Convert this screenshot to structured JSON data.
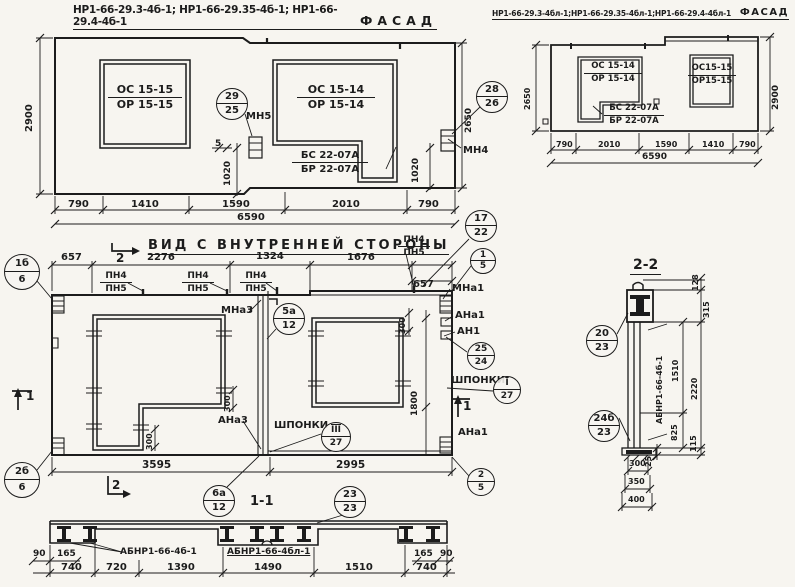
{
  "left_facade": {
    "codes": "НР1-66-29.3-4б-1; НР1-66-29.35-4б-1; НР1-66-29.4-4б-1",
    "view_label": "ФАСАД"
  },
  "right_facade": {
    "codes": "НР1-66-29.3-4бл-1;НР1-66-29.35-4бл-1;НР1-66-29.4-4бл-1",
    "view_label": "ФАСАД"
  },
  "inner_view": {
    "title": "ВИД С ВНУТРЕННЕЙ СТОРОНЫ"
  },
  "sections": {
    "s22": "2-2",
    "s11": "1-1"
  },
  "stacks": [
    {
      "n": "window1-left-facade-mark",
      "l1": "ОС 15-15",
      "l2": "ОР 15-15",
      "x": 108,
      "y": 84,
      "w": 74,
      "s": 11
    },
    {
      "n": "window2-left-facade-mark",
      "l1": "ОС 15-14",
      "l2": "ОР 15-14",
      "x": 297,
      "y": 84,
      "w": 78,
      "s": 11
    },
    {
      "n": "block-mark-left-facade",
      "l1": "БС 22-07А",
      "l2": "БР 22-07А",
      "x": 292,
      "y": 150,
      "w": 76,
      "s": 10
    },
    {
      "n": "window1-right-facade-mark",
      "l1": "ОС 15-14",
      "l2": "ОР 15-14",
      "x": 584,
      "y": 62,
      "w": 58,
      "s": 8.5
    },
    {
      "n": "window2-right-facade-mark",
      "l1": "ОС15-15",
      "l2": "ОР15-15",
      "x": 688,
      "y": 64,
      "w": 48,
      "s": 8.5
    },
    {
      "n": "block-mark-right-facade",
      "l1": "БС 22-07А",
      "l2": "БР 22-07А",
      "x": 604,
      "y": 104,
      "w": 60,
      "s": 8.5
    },
    {
      "n": "pn-mark-1",
      "l1": "ПН4",
      "l2": "ПН5",
      "x": 100,
      "y": 271,
      "w": 32,
      "s": 9
    },
    {
      "n": "pn-mark-2",
      "l1": "ПН4",
      "l2": "ПН5",
      "x": 182,
      "y": 271,
      "w": 32,
      "s": 9
    },
    {
      "n": "pn-mark-3",
      "l1": "ПН4",
      "l2": "ПН5",
      "x": 240,
      "y": 271,
      "w": 32,
      "s": 9
    },
    {
      "n": "pn-mark-4",
      "l1": "ПН4",
      "l2": "ПН5",
      "x": 398,
      "y": 235,
      "w": 32,
      "s": 9
    }
  ],
  "callouts": [
    {
      "n": "callout-29-25",
      "top": "29",
      "bot": "25",
      "x": 232,
      "y": 104,
      "r": 16
    },
    {
      "n": "callout-28-26",
      "top": "28",
      "bot": "26",
      "x": 492,
      "y": 97,
      "r": 16
    },
    {
      "n": "callout-1b-6",
      "top": "1б",
      "bot": "6",
      "x": 22,
      "y": 272,
      "r": 18
    },
    {
      "n": "callout-2b-6",
      "top": "2б",
      "bot": "6",
      "x": 22,
      "y": 480,
      "r": 18
    },
    {
      "n": "callout-17-22",
      "top": "17",
      "bot": "22",
      "x": 481,
      "y": 226,
      "r": 16
    },
    {
      "n": "callout-1-5",
      "top": "1",
      "bot": "5",
      "x": 483,
      "y": 261,
      "r": 13
    },
    {
      "n": "callout-5a-12",
      "top": "5а",
      "bot": "12",
      "x": 289,
      "y": 319,
      "r": 16
    },
    {
      "n": "callout-25-24",
      "top": "25",
      "bot": "24",
      "x": 481,
      "y": 356,
      "r": 14
    },
    {
      "n": "callout-I-27",
      "top": "I",
      "bot": "27",
      "x": 507,
      "y": 390,
      "r": 14,
      "ov": 1
    },
    {
      "n": "callout-III-27",
      "top": "III",
      "bot": "27",
      "x": 336,
      "y": 437,
      "r": 15,
      "ov": 1
    },
    {
      "n": "callout-2-5",
      "top": "2",
      "bot": "5",
      "x": 481,
      "y": 482,
      "r": 14
    },
    {
      "n": "callout-6a-12",
      "top": "6а",
      "bot": "12",
      "x": 219,
      "y": 501,
      "r": 16
    },
    {
      "n": "callout-23-23",
      "top": "23",
      "bot": "23",
      "x": 350,
      "y": 502,
      "r": 16
    },
    {
      "n": "callout-20-23",
      "top": "20",
      "bot": "23",
      "x": 602,
      "y": 341,
      "r": 16
    },
    {
      "n": "callout-24b-23",
      "top": "24б",
      "bot": "23",
      "x": 604,
      "y": 426,
      "r": 16
    }
  ],
  "annotations": [
    {
      "n": "anchor-label-mn5",
      "t": "МН5",
      "x": 246,
      "y": 111,
      "s": 10
    },
    {
      "n": "anchor-label-mn4",
      "t": "МН4",
      "x": 463,
      "y": 145,
      "s": 10
    },
    {
      "n": "dim-5",
      "t": "5",
      "x": 215,
      "y": 140,
      "s": 9
    },
    {
      "n": "dim-1020-left",
      "t": "1020",
      "x": 224,
      "y": 186,
      "s": 9,
      "r": 1
    },
    {
      "n": "dim-1020-right",
      "t": "1020",
      "x": 412,
      "y": 183,
      "s": 9,
      "r": 1
    },
    {
      "n": "dim-2900-left-facade",
      "t": "2900",
      "x": 24,
      "y": 132,
      "s": 10,
      "r": 1
    },
    {
      "n": "dim-2650-left-facade",
      "t": "2650",
      "x": 465,
      "y": 133,
      "s": 9,
      "r": 1
    },
    {
      "n": "dim-2650-right-facade",
      "t": "2650",
      "x": 524,
      "y": 110,
      "s": 8,
      "r": 1
    },
    {
      "n": "dim-2900-right-facade",
      "t": "2900",
      "x": 772,
      "y": 110,
      "s": 9,
      "r": 1
    },
    {
      "n": "dim-790-lf-1",
      "t": "790",
      "x": 68,
      "y": 199,
      "s": 10
    },
    {
      "n": "dim-1410-lf",
      "t": "1410",
      "x": 131,
      "y": 199,
      "s": 10
    },
    {
      "n": "dim-1590-lf",
      "t": "1590",
      "x": 222,
      "y": 199,
      "s": 10
    },
    {
      "n": "dim-2010-lf",
      "t": "2010",
      "x": 332,
      "y": 199,
      "s": 10
    },
    {
      "n": "dim-790-lf-2",
      "t": "790",
      "x": 418,
      "y": 199,
      "s": 10
    },
    {
      "n": "dim-6590-lf",
      "t": "6590",
      "x": 237,
      "y": 212,
      "s": 10
    },
    {
      "n": "dim-790-rf-1",
      "t": "790",
      "x": 556,
      "y": 141,
      "s": 8
    },
    {
      "n": "dim-2010-rf",
      "t": "2010",
      "x": 598,
      "y": 141,
      "s": 8
    },
    {
      "n": "dim-1590-rf",
      "t": "1590",
      "x": 655,
      "y": 141,
      "s": 8
    },
    {
      "n": "dim-1410-rf",
      "t": "1410",
      "x": 702,
      "y": 141,
      "s": 8
    },
    {
      "n": "dim-790-rf-2",
      "t": "790",
      "x": 739,
      "y": 141,
      "s": 8
    },
    {
      "n": "dim-6590-rf",
      "t": "6590",
      "x": 642,
      "y": 153,
      "s": 9
    },
    {
      "n": "dim-657-mv-left",
      "t": "657",
      "x": 61,
      "y": 252,
      "s": 10
    },
    {
      "n": "dim-2276-mv",
      "t": "2276",
      "x": 147,
      "y": 252,
      "s": 10
    },
    {
      "n": "dim-1324-mv",
      "t": "1324",
      "x": 256,
      "y": 251,
      "s": 10
    },
    {
      "n": "dim-1676-mv",
      "t": "1676",
      "x": 347,
      "y": 252,
      "s": 10
    },
    {
      "n": "dim-657-mv-right",
      "t": "657",
      "x": 413,
      "y": 279,
      "s": 10
    },
    {
      "n": "label-mna3",
      "t": "МНа3",
      "x": 221,
      "y": 305,
      "s": 10
    },
    {
      "n": "label-ana3",
      "t": "АНа3",
      "x": 218,
      "y": 415,
      "s": 10
    },
    {
      "n": "label-shponki-mid",
      "t": "ШПОНКИ",
      "x": 274,
      "y": 420,
      "s": 10
    },
    {
      "n": "label-mna1",
      "t": "МНа1",
      "x": 452,
      "y": 283,
      "s": 10
    },
    {
      "n": "label-ana1-top",
      "t": "АНа1",
      "x": 455,
      "y": 310,
      "s": 10
    },
    {
      "n": "label-an1",
      "t": "АН1",
      "x": 457,
      "y": 326,
      "s": 10
    },
    {
      "n": "label-shponki-right",
      "t": "ШПОНКИ",
      "x": 451,
      "y": 375,
      "s": 10
    },
    {
      "n": "label-ana1-bottom",
      "t": "АНа1",
      "x": 458,
      "y": 427,
      "s": 10
    },
    {
      "n": "dim-300-opening2",
      "t": "300",
      "x": 399,
      "y": 334,
      "s": 8,
      "r": 1
    },
    {
      "n": "dim-1800",
      "t": "1800",
      "x": 411,
      "y": 416,
      "s": 9,
      "r": 1
    },
    {
      "n": "dim-300-opening1",
      "t": "300",
      "x": 224,
      "y": 412,
      "s": 8,
      "r": 1
    },
    {
      "n": "dim-300-leg",
      "t": "300",
      "x": 146,
      "y": 450,
      "s": 8,
      "r": 1
    },
    {
      "n": "dim-3595",
      "t": "3595",
      "x": 142,
      "y": 460,
      "s": 10.5
    },
    {
      "n": "dim-2995",
      "t": "2995",
      "x": 336,
      "y": 460,
      "s": 10.5
    },
    {
      "n": "cut-2-top",
      "t": "2",
      "x": 116,
      "y": 252,
      "s": 12,
      "b": 1
    },
    {
      "n": "cut-2-bottom",
      "t": "2",
      "x": 112,
      "y": 479,
      "s": 12,
      "b": 1
    },
    {
      "n": "cut-1-left",
      "t": "1",
      "x": 26,
      "y": 390,
      "s": 12,
      "b": 1
    },
    {
      "n": "cut-1-right",
      "t": "1",
      "x": 463,
      "y": 400,
      "s": 12,
      "b": 1
    },
    {
      "n": "dim-128-s22",
      "t": "128",
      "x": 692,
      "y": 291,
      "s": 8,
      "r": 1
    },
    {
      "n": "dim-315-s22",
      "t": "315",
      "x": 703,
      "y": 318,
      "s": 8,
      "r": 1
    },
    {
      "n": "dim-1510-s22",
      "t": "1510",
      "x": 672,
      "y": 382,
      "s": 8,
      "r": 1
    },
    {
      "n": "dim-2220-s22",
      "t": "2220",
      "x": 691,
      "y": 400,
      "s": 8,
      "r": 1
    },
    {
      "n": "dim-825-s22",
      "t": "825",
      "x": 671,
      "y": 441,
      "s": 8,
      "r": 1
    },
    {
      "n": "dim-115-s22",
      "t": "115",
      "x": 690,
      "y": 452,
      "s": 8,
      "r": 1
    },
    {
      "n": "dim-25-s22",
      "t": "25",
      "x": 645,
      "y": 467,
      "s": 8,
      "r": 1
    },
    {
      "n": "label-abnr-s22",
      "t": "АБНР1-66-4б-1",
      "x": 656,
      "y": 424,
      "s": 8,
      "r": 1
    },
    {
      "n": "dim-300-s22",
      "t": "300",
      "x": 629,
      "y": 460,
      "s": 8
    },
    {
      "n": "dim-350-s22",
      "t": "350",
      "x": 628,
      "y": 478,
      "s": 8
    },
    {
      "n": "dim-400-s22",
      "t": "400",
      "x": 628,
      "y": 496,
      "s": 8
    },
    {
      "n": "label-abnr-s11-a",
      "t": "АБНР1-66-4б-1",
      "x": 120,
      "y": 548,
      "s": 9
    },
    {
      "n": "label-abnr-s11-b",
      "t": "АБНР1-66-4бл-1",
      "x": 227,
      "y": 548,
      "s": 9,
      "u": 1
    },
    {
      "n": "dim-90-left",
      "t": "90",
      "x": 33,
      "y": 550,
      "s": 9
    },
    {
      "n": "dim-165-left",
      "t": "165",
      "x": 57,
      "y": 550,
      "s": 9
    },
    {
      "n": "dim-165-right",
      "t": "165",
      "x": 414,
      "y": 550,
      "s": 9
    },
    {
      "n": "dim-90-right",
      "t": "90",
      "x": 440,
      "y": 550,
      "s": 9
    },
    {
      "n": "dim-740-s11-1",
      "t": "740",
      "x": 61,
      "y": 562,
      "s": 10
    },
    {
      "n": "dim-720-s11",
      "t": "720",
      "x": 106,
      "y": 562,
      "s": 10
    },
    {
      "n": "dim-1390-s11",
      "t": "1390",
      "x": 167,
      "y": 562,
      "s": 10
    },
    {
      "n": "dim-1490-s11",
      "t": "1490",
      "x": 254,
      "y": 562,
      "s": 10
    },
    {
      "n": "dim-1510-s11",
      "t": "1510",
      "x": 345,
      "y": 562,
      "s": 10
    },
    {
      "n": "dim-740-s11-2",
      "t": "740",
      "x": 416,
      "y": 562,
      "s": 10
    }
  ],
  "colors": {
    "ink": "#1c1c1c",
    "paper": "#f7f5f0"
  }
}
